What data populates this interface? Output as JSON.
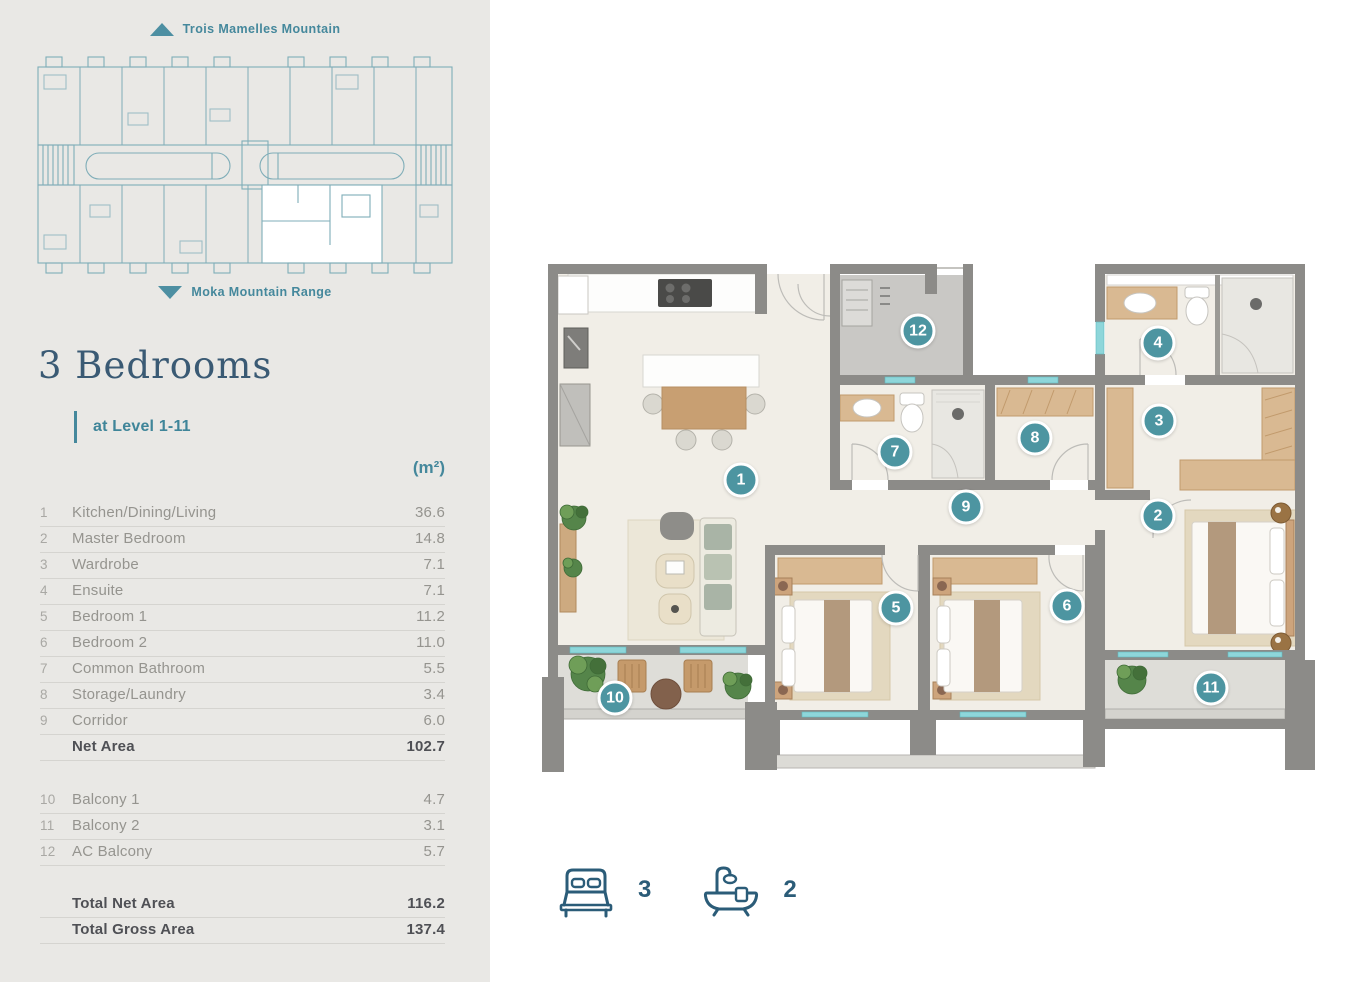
{
  "sidebar": {
    "keyplan": {
      "top_label": "Trois Mamelles Mountain",
      "bottom_label": "Moka Mountain Range"
    },
    "title": "3 Bedrooms",
    "level": "at Level 1-11",
    "unit_header": "(m²)",
    "rooms": [
      {
        "num": "1",
        "label": "Kitchen/Dining/Living",
        "value": "36.6",
        "bold": false
      },
      {
        "num": "2",
        "label": "Master Bedroom",
        "value": "14.8",
        "bold": false
      },
      {
        "num": "3",
        "label": "Wardrobe",
        "value": "7.1",
        "bold": false
      },
      {
        "num": "4",
        "label": "Ensuite",
        "value": "7.1",
        "bold": false
      },
      {
        "num": "5",
        "label": "Bedroom 1",
        "value": "11.2",
        "bold": false
      },
      {
        "num": "6",
        "label": "Bedroom 2",
        "value": "11.0",
        "bold": false
      },
      {
        "num": "7",
        "label": "Common Bathroom",
        "value": "5.5",
        "bold": false
      },
      {
        "num": "8",
        "label": "Storage/Laundry",
        "value": "3.4",
        "bold": false
      },
      {
        "num": "9",
        "label": "Corridor",
        "value": "6.0",
        "bold": false
      },
      {
        "num": "",
        "label": "Net Area",
        "value": "102.7",
        "bold": true
      }
    ],
    "balconies": [
      {
        "num": "10",
        "label": "Balcony 1",
        "value": "4.7",
        "bold": false
      },
      {
        "num": "11",
        "label": "Balcony 2",
        "value": "3.1",
        "bold": false
      },
      {
        "num": "12",
        "label": "AC Balcony",
        "value": "5.7",
        "bold": false
      }
    ],
    "totals": [
      {
        "num": "",
        "label": "Total Net Area",
        "value": "116.2",
        "bold": true
      },
      {
        "num": "",
        "label": "Total Gross Area",
        "value": "137.4",
        "bold": true
      }
    ]
  },
  "plan": {
    "markers": [
      {
        "n": "1",
        "x": 201,
        "y": 218
      },
      {
        "n": "2",
        "x": 618,
        "y": 254
      },
      {
        "n": "3",
        "x": 619,
        "y": 159
      },
      {
        "n": "4",
        "x": 618,
        "y": 81
      },
      {
        "n": "5",
        "x": 356,
        "y": 346
      },
      {
        "n": "6",
        "x": 527,
        "y": 344
      },
      {
        "n": "7",
        "x": 355,
        "y": 190
      },
      {
        "n": "8",
        "x": 495,
        "y": 176
      },
      {
        "n": "9",
        "x": 426,
        "y": 245
      },
      {
        "n": "10",
        "x": 75,
        "y": 436
      },
      {
        "n": "11",
        "x": 671,
        "y": 426
      },
      {
        "n": "12",
        "x": 378,
        "y": 69
      }
    ]
  },
  "stats": {
    "bedrooms": "3",
    "bathrooms": "2"
  },
  "colors": {
    "marker_teal": "#4d95a1",
    "label_teal": "#45889c",
    "title_blue": "#3a5a74",
    "stat_blue": "#2b5c78",
    "sidebar_bg": "#e9e8e5",
    "wall_gray": "#8c8b88",
    "floor_cream": "#f1eee7",
    "window_cyan": "#8ed6da",
    "wood_tan": "#d9b992"
  }
}
